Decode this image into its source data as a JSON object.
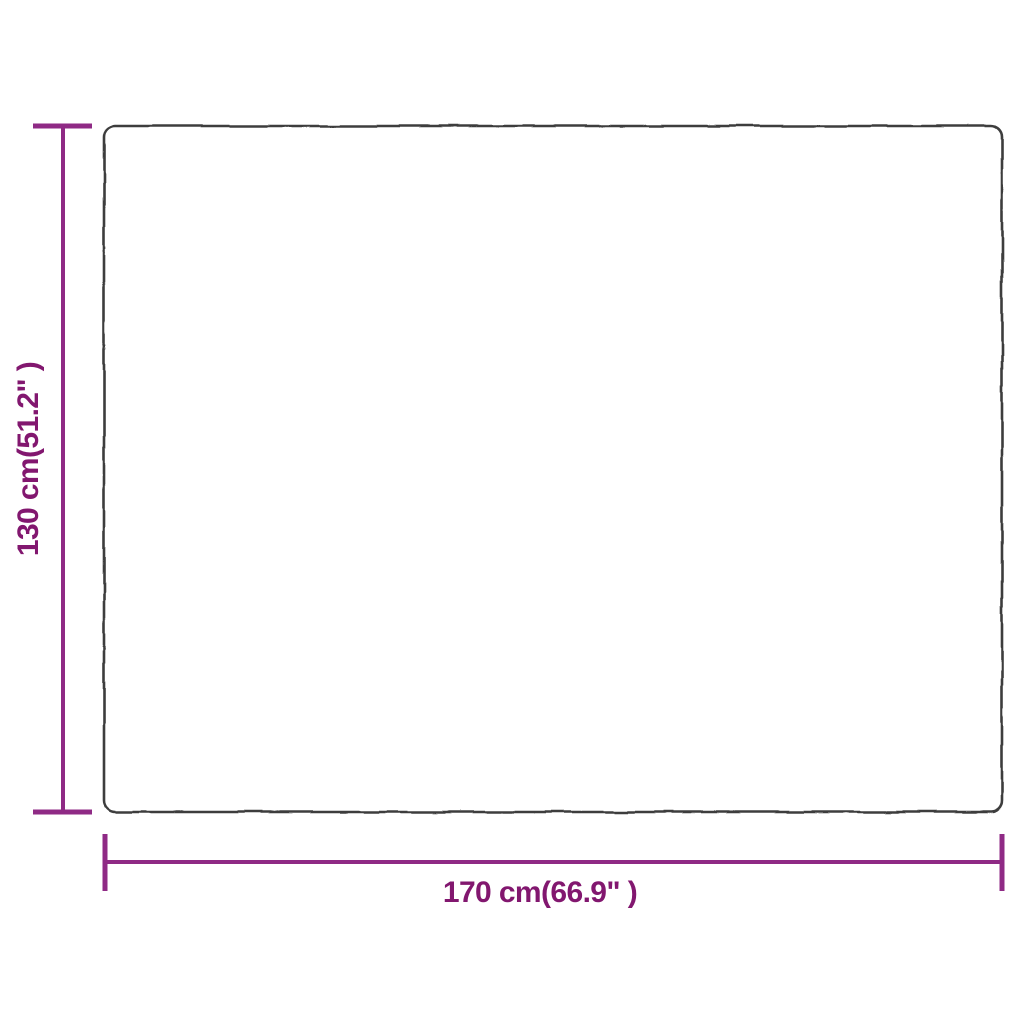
{
  "page": {
    "background_color": "#ffffff",
    "description": "Product size diagram of a rectangular item (blanket) with width and height dimension arrows"
  },
  "diagram": {
    "shape": "rectangle-outline",
    "outline_color": "#3d3d3d",
    "dimension_line_color": "#8f2a85",
    "label_color": "#82176f",
    "height": {
      "label": "130 cm(51.2\" )",
      "value_cm": "130 cm",
      "value_in": "51.2\""
    },
    "width": {
      "label": "170 cm(66.9\" )",
      "value_cm": "170 cm",
      "value_in": "66.9\""
    }
  }
}
